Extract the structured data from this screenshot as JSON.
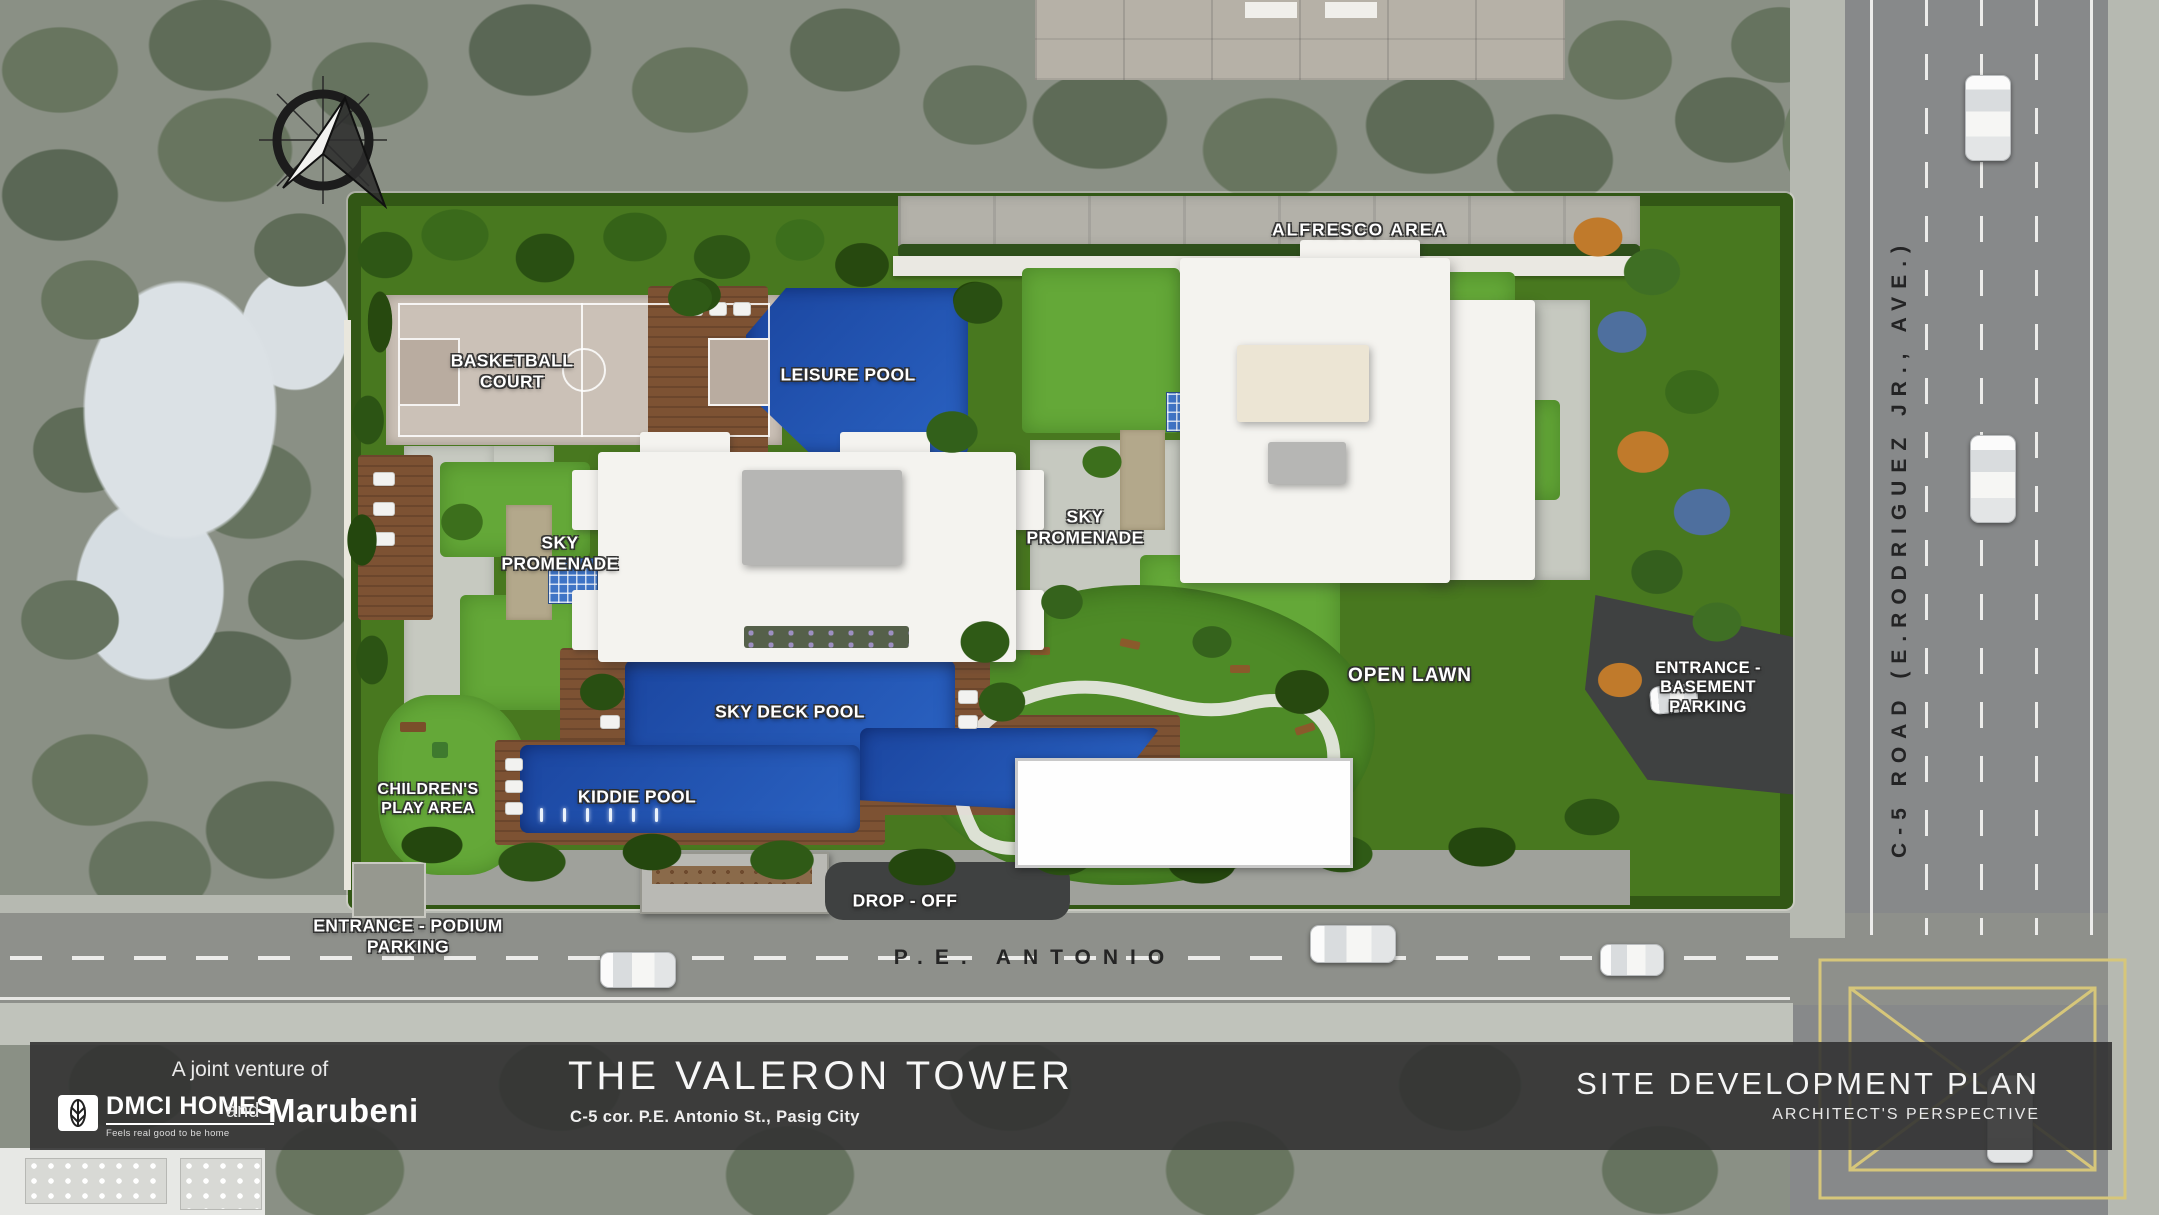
{
  "site_plan": {
    "amenity_labels": {
      "alfresco_area": "ALFRESCO AREA",
      "basketball_court": "BASKETBALL COURT",
      "leisure_pool": "LEISURE POOL",
      "sky_promenade_left": "SKY PROMENADE",
      "sky_promenade_right": "SKY PROMENADE",
      "sky_deck_pool": "SKY DECK POOL",
      "kiddie_pool": "KIDDIE POOL",
      "childrens_play_area": "CHILDREN'S PLAY AREA",
      "open_lawn": "OPEN LAWN",
      "drop_off": "DROP - OFF"
    },
    "entrance_labels": {
      "basement_parking": "ENTRANCE - BASEMENT PARKING",
      "podium_parking": "ENTRANCE - PODIUM PARKING"
    },
    "road_labels": {
      "pe_antonio": "P.E. ANTONIO",
      "c5_road": "C-5 ROAD (E.RODRIGUEZ JR., AVE.)"
    },
    "icons": {
      "compass": "compass-rose",
      "cars": "car-top-view",
      "lane_arrow": "down-arrow"
    }
  },
  "footer": {
    "joint_venture_text": "A joint venture of",
    "dmci_name": "DMCI HOMES",
    "dmci_tagline": "Feels real good to be home",
    "and_text": "and",
    "marubeni_name": "Marubeni",
    "project_title": "THE VALERON TOWER",
    "project_address": "C-5 cor. P.E. Antonio St., Pasig City",
    "plan_title": "SITE DEVELOPMENT PLAN",
    "plan_subtitle": "ARCHITECT'S PERSPECTIVE"
  },
  "colors": {
    "site_green": "#48781f",
    "lawn_green": "#64a838",
    "pool_blue": "#1d4da6",
    "wood_deck": "#7d5233",
    "court_tan": "#cbc1b7",
    "road_gray": "#8b8d8a",
    "asphalt_dark": "#3f4141",
    "junction_yellow": "#d6c67a",
    "footer_bg": "#333333",
    "surroundings_muted": "#8a9085"
  }
}
